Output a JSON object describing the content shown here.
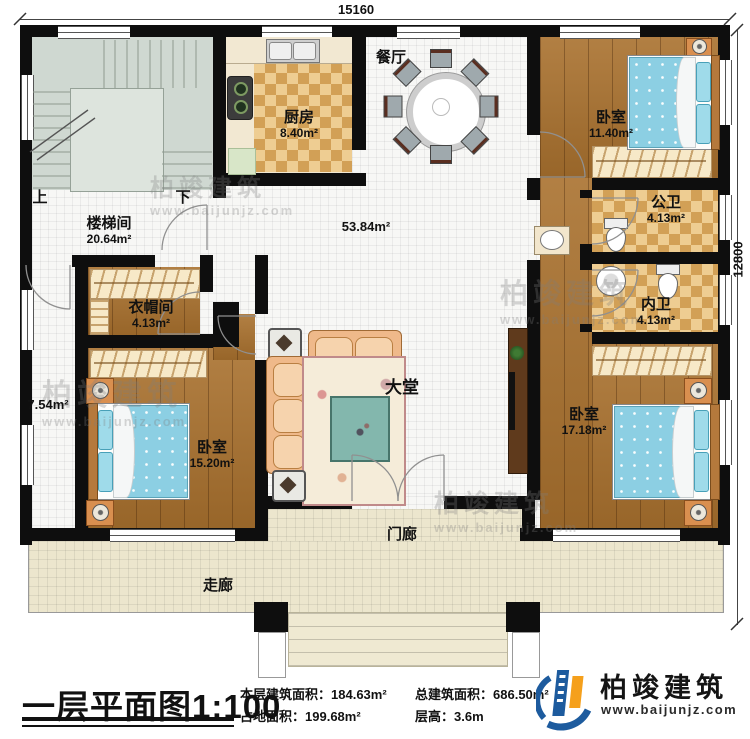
{
  "dimensions": {
    "top": "15160",
    "right": "12800"
  },
  "rooms": {
    "stairwell": {
      "name": "楼梯间",
      "area": "20.64m²",
      "up": "上",
      "down": "下"
    },
    "kitchen": {
      "name": "厨房",
      "area": "8.40m²"
    },
    "dining": {
      "name": "餐厅"
    },
    "hall": {
      "name": "大堂",
      "area": "53.84m²"
    },
    "bedroom_ne": {
      "name": "卧室",
      "area": "11.40m²"
    },
    "public_bath": {
      "name": "公卫",
      "area": "4.13m²"
    },
    "inner_bath": {
      "name": "内卫",
      "area": "4.13m²"
    },
    "bedroom_se": {
      "name": "卧室",
      "area": "17.18m²"
    },
    "cloakroom": {
      "name": "衣帽间",
      "area": "4.13m²"
    },
    "bedroom_sw": {
      "name": "卧室",
      "area": "15.20m²"
    },
    "west_corridor": {
      "area": "7.54m²"
    },
    "porch": {
      "name": "门廊"
    },
    "veranda": {
      "name": "走廊"
    }
  },
  "footer": {
    "title": "一层平面图1:100",
    "stats": [
      {
        "label": "本层建筑面积：",
        "value": "184.63m²"
      },
      {
        "label": "占地面积：",
        "value": "199.68m²"
      },
      {
        "label": "总建筑面积：",
        "value": "686.50m²"
      },
      {
        "label": "层高：",
        "value": "3.6m"
      }
    ],
    "logo": {
      "name": "柏竣建筑",
      "url": "www.baijunjz.com"
    }
  },
  "watermark": {
    "name": "柏竣建筑",
    "url": "www.baijunjz.com"
  },
  "colors": {
    "logo_blue": "#1d5b9e",
    "logo_orange": "#f5a01c",
    "wall": "#0e0e0e"
  }
}
